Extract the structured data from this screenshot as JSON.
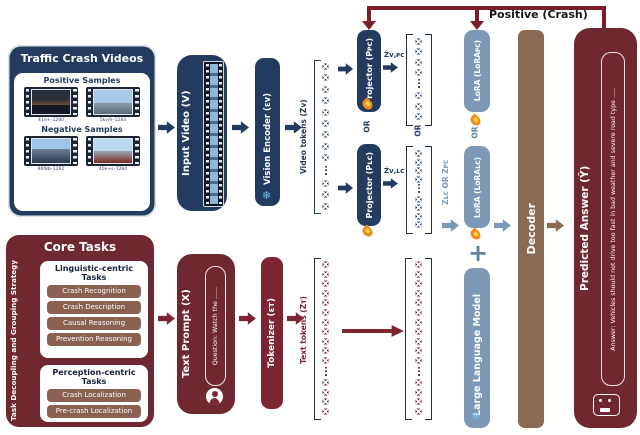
{
  "or": "OR",
  "plus": "+",
  "feedback": {
    "label": "Positive (Crash)"
  },
  "icons": {
    "snowflake": "❄"
  },
  "videos": {
    "title": "Traffic Crash Videos",
    "positive": "Positive Samples",
    "negative": "Negative Samples",
    "captions": [
      "41d+–1280",
      "5kv/h–1284",
      "96f8b–1282",
      "40e+s–1284"
    ]
  },
  "input_video": {
    "label": "Input Video (V)"
  },
  "vision_encoder": {
    "label": "Vision Encoder (εᴠ)"
  },
  "labels": {
    "video_tokens": "Video tokens (Zᴠ)",
    "text_tokens": "Text tokens (Zᴛ)"
  },
  "projector_top": {
    "label": "Projector (Pᴘᴄ)",
    "output": "Ẑᴠ,ᴘᴄ"
  },
  "projector_bottom": {
    "label": "Projector (Pʟᴄ)",
    "output": "Ẑᴠ,ʟᴄ"
  },
  "zselect": {
    "label": "Zʟᴄ OR Zᴘᴄ"
  },
  "lora_top": {
    "label": "LoRA (LoRAᴘᴄ)"
  },
  "lora_bottom": {
    "label": "LoRA (LoRAʟᴄ)"
  },
  "llm": {
    "label": "Large Language Model"
  },
  "decoder": {
    "label": "Decoder"
  },
  "answer": {
    "title": "Predicted Answer (Ŷ)",
    "text": "Answer: Vehicles should not drive too fast in bad weather and severe road type ....."
  },
  "core": {
    "title": "Core Tasks",
    "strategy": "Task Decoupling and Grouping Strategy",
    "linguistic": {
      "title": "Linguistic-centric Tasks",
      "items": [
        "Crash Recognition",
        "Crash Description",
        "Causal Reasoning",
        "Prevention Reasoning"
      ]
    },
    "perception": {
      "title": "Perception-centric Tasks",
      "items": [
        "Crash Localization",
        "Pre-crash Localization"
      ]
    }
  },
  "prompt": {
    "label": "Text Prompt (X)",
    "question": "Question: Watch the ......"
  },
  "tokenizer": {
    "label": "Tokenizer (εᴛ)"
  },
  "colors": {
    "navy": "#233b5e",
    "maroon": "#7d2531",
    "steel": "#7d99b6",
    "brown": "#8a6a52",
    "dark_red": "#702830",
    "feedback_red": "#7e1c28"
  }
}
